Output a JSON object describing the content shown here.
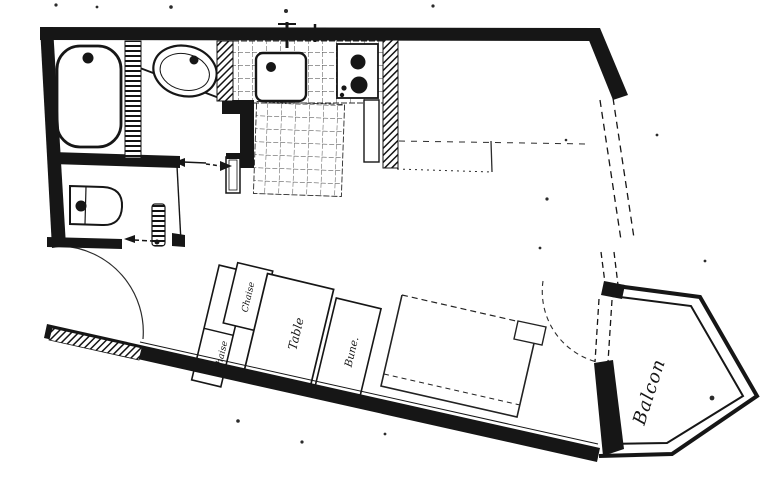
{
  "plan": {
    "labels": {
      "chaise_top": "Chaise",
      "chaise_left": "Chaise",
      "table": "Table",
      "desk": "Bune.",
      "balcony": "Balcon"
    },
    "colors": {
      "ink": "#161616",
      "paper": "#ffffff"
    }
  }
}
